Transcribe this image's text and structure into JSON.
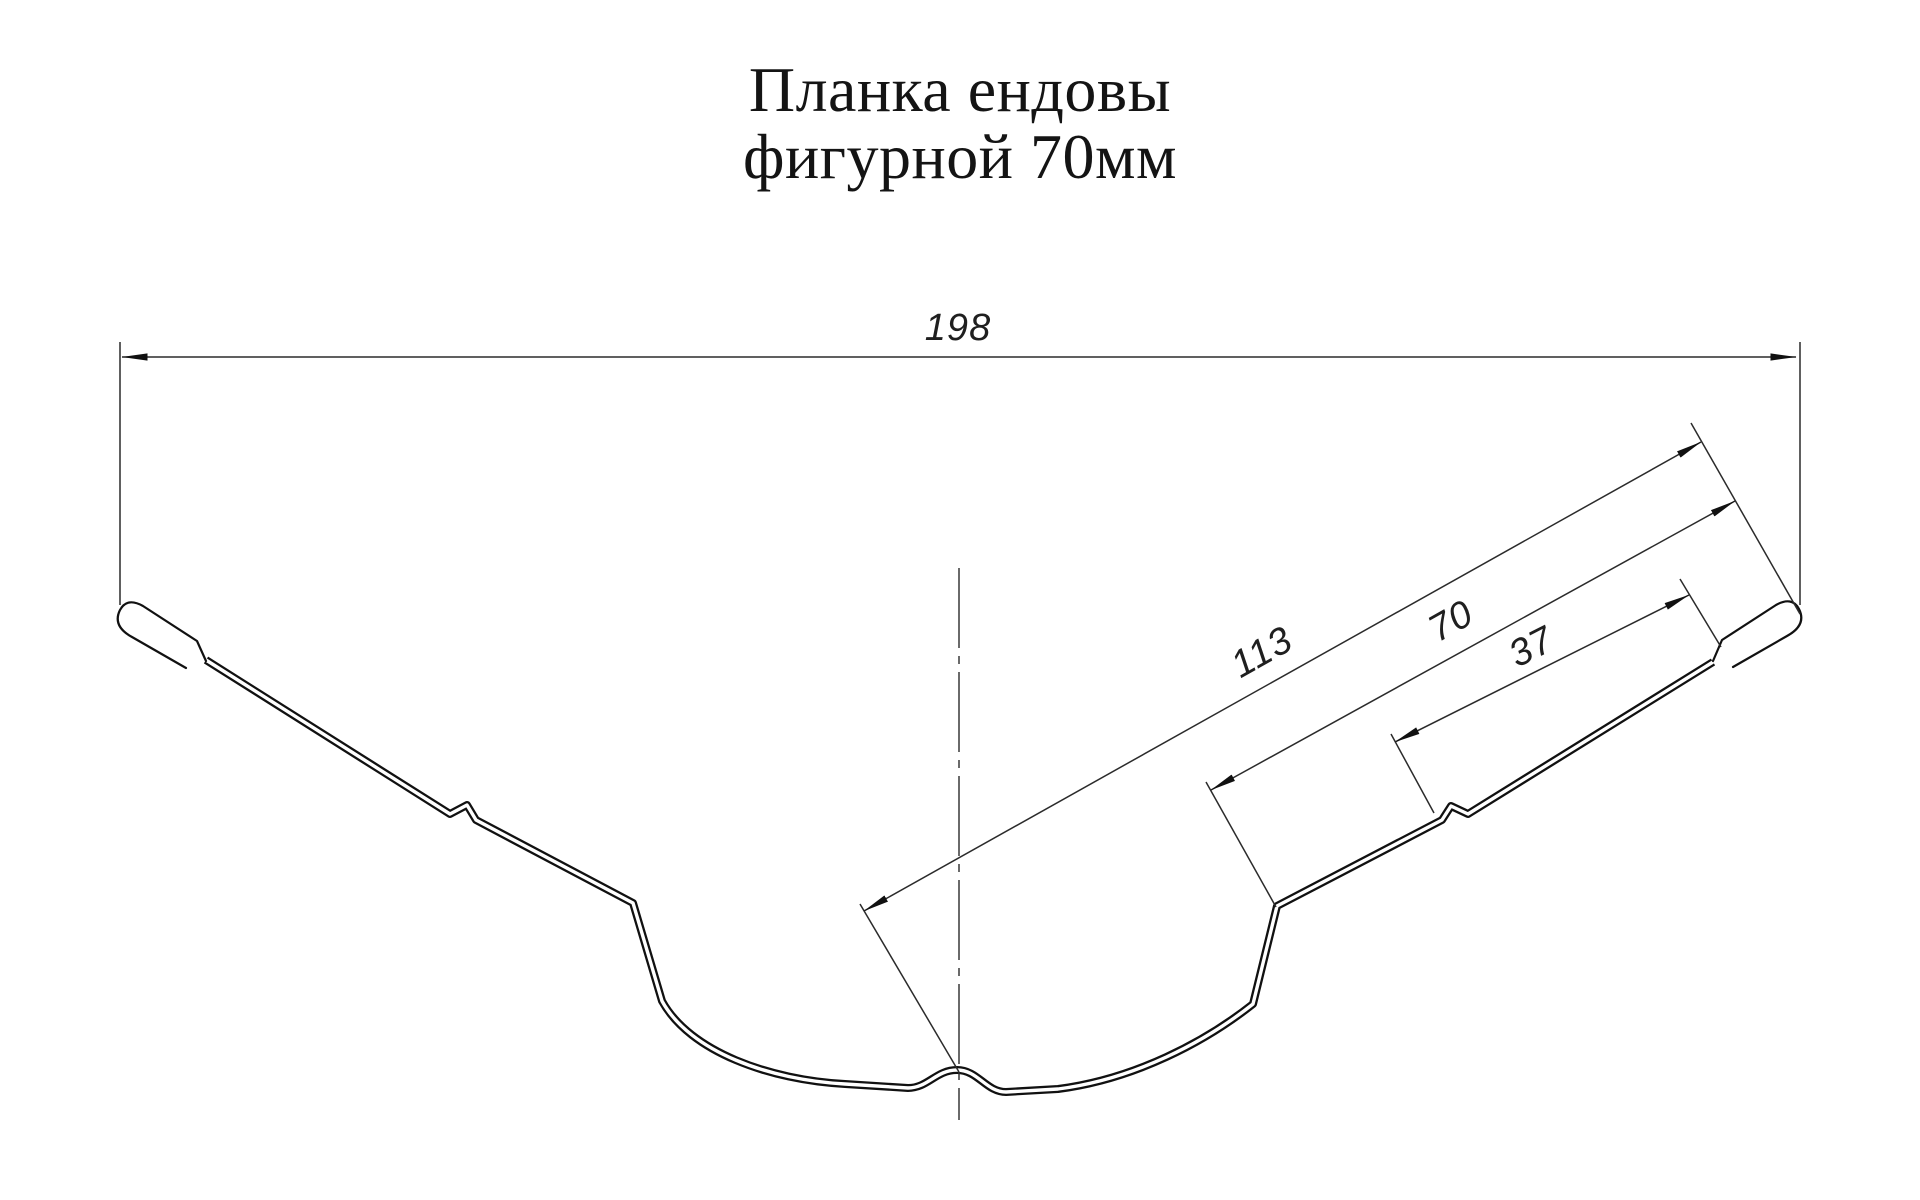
{
  "title": {
    "line1": "Планка ендовы",
    "line2": "фигурной 70мм"
  },
  "dimensions": {
    "total_width": "198",
    "valley_to_edge": "113",
    "flange_width": "70",
    "edge_section": "37"
  },
  "colors": {
    "background": "#ffffff",
    "line": "#111111",
    "dim_line": "#2b2b2b",
    "text": "#141414"
  }
}
